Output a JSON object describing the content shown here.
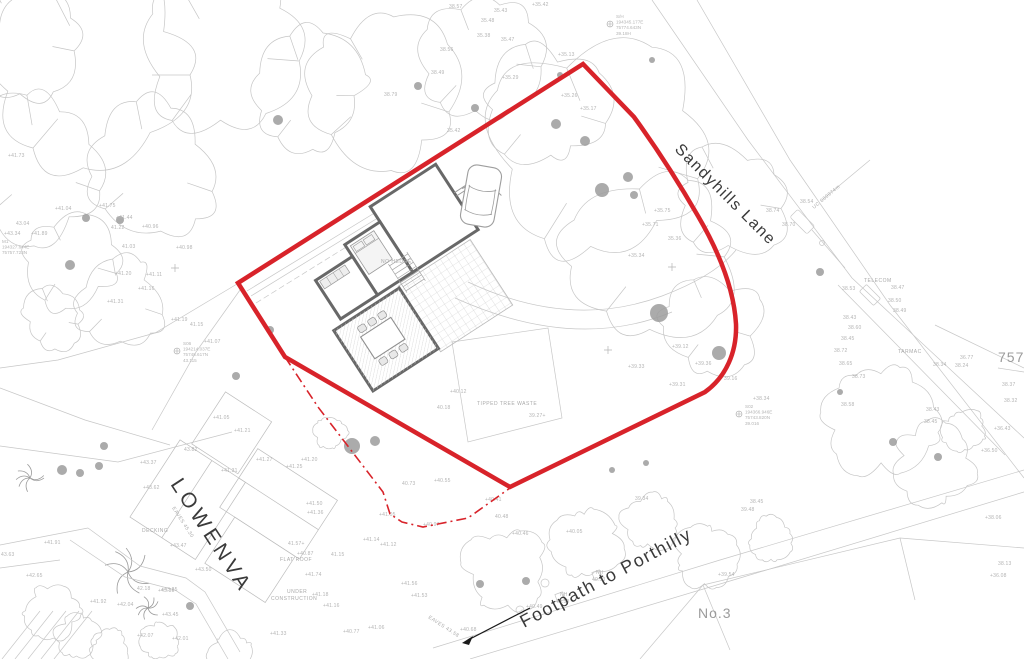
{
  "labels": {
    "road": "Sandyhills Lane",
    "property": "LOWENVA",
    "footpath": "Footpath to Porthilly",
    "neighbour": "No.3",
    "parcel": "757"
  },
  "colors": {
    "boundary_red": "#d8232a",
    "linework_gray": "#c7c7c7",
    "annotation_gray": "#b4b4b4"
  },
  "site_labels": [
    [
      "TELECOM",
      864,
      282,
      0
    ],
    [
      "TARMAC",
      898,
      353,
      0
    ],
    [
      "TIPPED TREE WASTE",
      477,
      405,
      0
    ],
    [
      "DECKING",
      142,
      532,
      0
    ],
    [
      "FLAT ROOF",
      280,
      561,
      0
    ],
    [
      "UNDER",
      287,
      593,
      0
    ],
    [
      "CONSTRUCTION",
      271,
      600,
      0
    ],
    [
      "NO HEDGE",
      381,
      263,
      0
    ],
    [
      "EAVES 45.30",
      172,
      508,
      57
    ],
    [
      "EAVES 43.58",
      428,
      618,
      33
    ],
    [
      "UC 600974m",
      814,
      209,
      -40
    ]
  ],
  "stations": [
    {
      "x": 616,
      "y": 18,
      "lines": [
        "S/H",
        "194345.177E",
        "75774.643N",
        "39.18H"
      ]
    },
    {
      "x": 183,
      "y": 345,
      "lines": [
        "S06",
        "194214.037E",
        "75748.617N",
        "43.115"
      ]
    },
    {
      "x": 2,
      "y": 243,
      "lines": [
        "M1",
        "194327.644E",
        "75757.723N"
      ]
    },
    {
      "x": 745,
      "y": 408,
      "lines": [
        "S02",
        "194366.946E",
        "75743.820N",
        "39.016"
      ]
    }
  ],
  "survey_points": [
    [
      "38.57",
      449,
      8
    ],
    [
      "35.43",
      494,
      12
    ],
    [
      "+35.42",
      532,
      6
    ],
    [
      "35.48",
      481,
      22
    ],
    [
      "35.38",
      477,
      37
    ],
    [
      "35.47",
      501,
      41
    ],
    [
      "38.56",
      440,
      51
    ],
    [
      "38.49",
      431,
      74
    ],
    [
      "38.79",
      384,
      96
    ],
    [
      "+35.13",
      558,
      56
    ],
    [
      "+35.29",
      502,
      79
    ],
    [
      "+35.26",
      561,
      97
    ],
    [
      "+35.17",
      580,
      110
    ],
    [
      "35.42",
      447,
      132
    ],
    [
      "+35.75",
      654,
      212
    ],
    [
      "+35.71",
      642,
      226
    ],
    [
      "+35.34",
      628,
      257
    ],
    [
      "35.36",
      668,
      240
    ],
    [
      "38.54",
      800,
      203
    ],
    [
      "38.74",
      766,
      212
    ],
    [
      "38.70",
      782,
      226
    ],
    [
      "38.53",
      842,
      290
    ],
    [
      "38.47",
      891,
      289
    ],
    [
      "38.50",
      888,
      302
    ],
    [
      "38.49",
      893,
      312
    ],
    [
      "38.43",
      843,
      319
    ],
    [
      "38.60",
      848,
      329
    ],
    [
      "38.45",
      841,
      340
    ],
    [
      "38.72",
      834,
      352
    ],
    [
      "38.65",
      839,
      365
    ],
    [
      "38.73",
      852,
      378
    ],
    [
      "36.77",
      960,
      359
    ],
    [
      "38.34",
      933,
      366
    ],
    [
      "38.24",
      955,
      367
    ],
    [
      "38.58",
      841,
      406
    ],
    [
      "38.43",
      926,
      411
    ],
    [
      "38.45",
      924,
      423
    ],
    [
      "38.37",
      1002,
      386
    ],
    [
      "38.32",
      1004,
      402
    ],
    [
      "+36.43",
      994,
      430
    ],
    [
      "+36.50",
      981,
      452
    ],
    [
      "+38.06",
      985,
      519
    ],
    [
      "38.13",
      998,
      565
    ],
    [
      "+36.08",
      990,
      577
    ],
    [
      "+41.73",
      8,
      157
    ],
    [
      "43.04",
      16,
      225
    ],
    [
      "+43.34",
      4,
      235
    ],
    [
      "+41.89",
      31,
      235
    ],
    [
      "+41.04",
      55,
      210
    ],
    [
      "+41.75",
      99,
      207
    ],
    [
      "+41.44",
      116,
      219
    ],
    [
      "+40.96",
      142,
      228
    ],
    [
      "41.22",
      111,
      229
    ],
    [
      "41.03",
      122,
      248
    ],
    [
      "+40.98",
      176,
      249
    ],
    [
      "+41.20",
      115,
      275
    ],
    [
      "+41.11",
      146,
      276
    ],
    [
      "+41.16",
      138,
      290
    ],
    [
      "+41.31",
      107,
      303
    ],
    [
      "+41.19",
      171,
      321
    ],
    [
      "41.15",
      190,
      326
    ],
    [
      "+41.07",
      204,
      343
    ],
    [
      "+41.05",
      213,
      419
    ],
    [
      "+41.21",
      234,
      432
    ],
    [
      "+43.37",
      140,
      464
    ],
    [
      "+43.62",
      143,
      489
    ],
    [
      "+43.47",
      170,
      547
    ],
    [
      "+43.50",
      195,
      571
    ],
    [
      "+43.25",
      161,
      591
    ],
    [
      "+41.91",
      44,
      544
    ],
    [
      "43.63",
      1,
      556
    ],
    [
      "+42.65",
      26,
      577
    ],
    [
      "+41.92",
      90,
      603
    ],
    [
      "+42.04",
      117,
      606
    ],
    [
      "42.18",
      137,
      590
    ],
    [
      "+43.35",
      158,
      592
    ],
    [
      "+43.45",
      162,
      616
    ],
    [
      "+42.07",
      137,
      637
    ],
    [
      "+42.01",
      172,
      640
    ],
    [
      "43.82",
      184,
      451
    ],
    [
      "+41.27",
      256,
      461
    ],
    [
      "+41.20",
      301,
      461
    ],
    [
      "+41.25",
      286,
      468
    ],
    [
      "+41.31",
      221,
      472
    ],
    [
      "+41.50",
      306,
      505
    ],
    [
      "+41.36",
      307,
      514
    ],
    [
      "41.57+",
      288,
      545
    ],
    [
      "+40.87",
      297,
      555
    ],
    [
      "41.15",
      331,
      556
    ],
    [
      "+41.74",
      305,
      576
    ],
    [
      "+41.18",
      312,
      596
    ],
    [
      "+41.16",
      323,
      607
    ],
    [
      "+41.14",
      363,
      541
    ],
    [
      "+41.12",
      380,
      546
    ],
    [
      "+41.05",
      379,
      516
    ],
    [
      "+40.97",
      423,
      526
    ],
    [
      "+41.33",
      270,
      635
    ],
    [
      "+41.06",
      368,
      629
    ],
    [
      "+40.77",
      343,
      633
    ],
    [
      "+40.68",
      460,
      631
    ],
    [
      "+41.56",
      401,
      585
    ],
    [
      "+41.53",
      411,
      597
    ],
    [
      "+40.46",
      512,
      535
    ],
    [
      "40.48",
      495,
      518
    ],
    [
      "+40.05",
      566,
      533
    ],
    [
      "39.34",
      635,
      500
    ],
    [
      "38.45",
      750,
      503
    ],
    [
      "39.48",
      741,
      511
    ],
    [
      "+39.54",
      718,
      576
    ],
    [
      "NH",
      596,
      574
    ],
    [
      "40.53",
      592,
      581
    ],
    [
      "NH",
      560,
      596
    ],
    [
      "40.59",
      556,
      603
    ],
    [
      "+40.49",
      526,
      608
    ],
    [
      "39.27+",
      529,
      417
    ],
    [
      "+40.12",
      450,
      393
    ],
    [
      "40.18",
      437,
      409
    ],
    [
      "+40.55",
      434,
      482
    ],
    [
      "40.73",
      402,
      485
    ],
    [
      "+40.41",
      485,
      501
    ],
    [
      "+39.33",
      628,
      368
    ],
    [
      "+39.36",
      695,
      365
    ],
    [
      "+39.31",
      669,
      386
    ],
    [
      "+38.34",
      753,
      400
    ],
    [
      "39.16",
      724,
      380
    ],
    [
      "+39.12",
      672,
      348
    ]
  ]
}
